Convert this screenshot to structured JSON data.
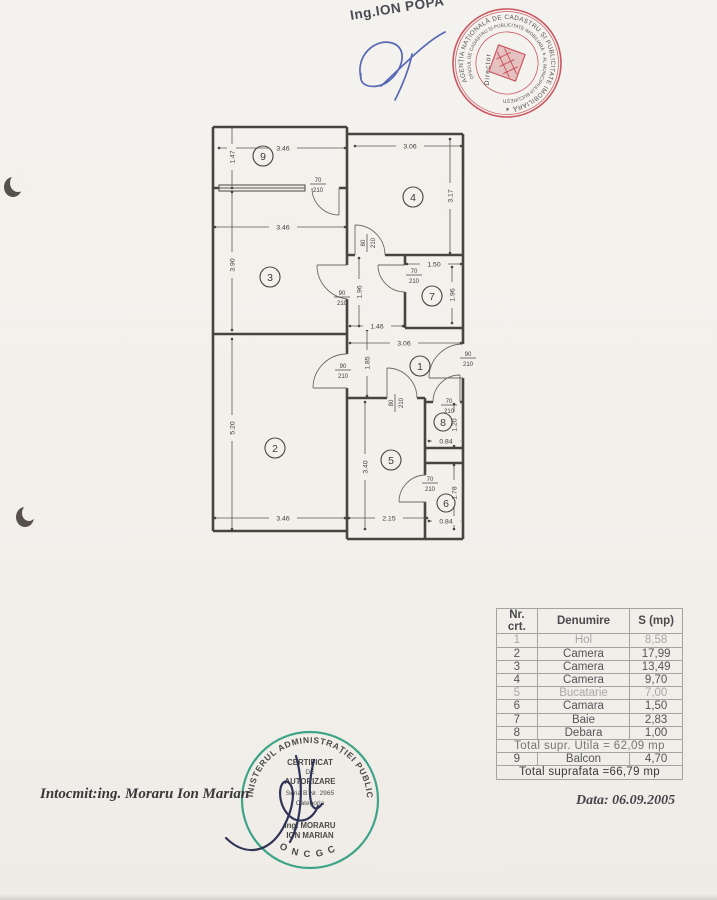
{
  "document": {
    "top_engineer": "Ing.ION POPA",
    "prepared_by": "Intocmit:ing. Moraru Ion Marian",
    "date": "Data: 06.09.2005"
  },
  "red_stamp": {
    "ring_outer": "AGENȚIA NAȚIONALĂ DE CADASTRU ȘI PUBLICITATE IMOBILIARĂ ✶",
    "ring_inner": "OFICIUL DE CADASTRU ȘI PUBLICITATE IMOBILIARĂ ✶ AL MUNICIPIULUI BUCUREȘTI",
    "role": "Director",
    "color": "#c5434e"
  },
  "green_stamp": {
    "ring": "MINISTERUL ADMINISTRAȚIEI PUBLICE",
    "bottom": "ONCGC",
    "line1": "CERTIFICAT",
    "line2": "DE",
    "line3": "AUTORIZARE",
    "line4": "Seria B Nr. 2965",
    "line5": "Categoria",
    "line6": "Ing. MORARU",
    "line7": "ION MARIAN",
    "color": "#2f9e80"
  },
  "signatures": {
    "top_ink": "#3c50aa",
    "bottom_ink": "#272b50"
  },
  "plan": {
    "rooms": {
      "r1": "1",
      "r2": "2",
      "r3": "3",
      "r4": "4",
      "r5": "5",
      "r6": "6",
      "r7": "7",
      "r8": "8",
      "r9": "9"
    },
    "dims": {
      "balcony_w": "3.46",
      "balcony_h": "1.47",
      "room4_w": "3.06",
      "room4_h": "3.17",
      "room3_w": "3.46",
      "room3_h": "3.90",
      "room7_w": "1.50",
      "room7_h": "1.96",
      "corridor_h": "1.96",
      "corridor_w": "1.46",
      "hall_w": "3.06",
      "hall_h": "1.85",
      "room2_h": "5.20",
      "room2_w": "3.46",
      "room5_h": "3.40",
      "room5_w": "2.15",
      "room8_h": "1.20",
      "room8_w": "0.84",
      "room6_h": "1.78",
      "room6_w": "0.84"
    },
    "doors": {
      "balcony": {
        "w": "70",
        "h": "210"
      },
      "room3": {
        "w": "90",
        "h": "210"
      },
      "room4": {
        "w": "80",
        "h": "210"
      },
      "room7": {
        "w": "70",
        "h": "210"
      },
      "room2": {
        "w": "90",
        "h": "210"
      },
      "room5": {
        "w": "80",
        "h": "210"
      },
      "entrance": {
        "w": "90",
        "h": "210"
      },
      "room8": {
        "w": "70",
        "h": "210"
      },
      "room6": {
        "w": "70",
        "h": "210"
      }
    }
  },
  "table": {
    "headers": {
      "nr": "Nr. crt.",
      "name": "Denumire",
      "area": "S (mp)"
    },
    "rows": [
      {
        "nr": "1",
        "name": "Hol",
        "area": "8,58"
      },
      {
        "nr": "2",
        "name": "Camera",
        "area": "17,99"
      },
      {
        "nr": "3",
        "name": "Camera",
        "area": "13,49"
      },
      {
        "nr": "4",
        "name": "Camera",
        "area": "9,70"
      },
      {
        "nr": "5",
        "name": "Bucatarie",
        "area": "7,00"
      },
      {
        "nr": "6",
        "name": "Camara",
        "area": "1,50"
      },
      {
        "nr": "7",
        "name": "Baie",
        "area": "2,83"
      },
      {
        "nr": "8",
        "name": "Debara",
        "area": "1,00"
      }
    ],
    "subtotal": "Total supr. Utila = 62,09 mp",
    "row9": {
      "nr": "9",
      "name": "Balcon",
      "area": "4,70"
    },
    "total": "Total suprafata =66,79 mp"
  }
}
